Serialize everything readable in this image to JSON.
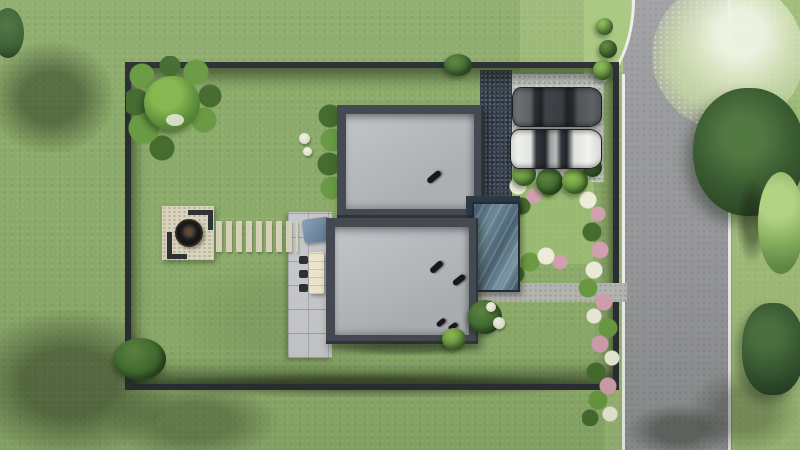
{
  "scene": {
    "title": "Aerial 3D render of a residential plot",
    "description": "Top-down architectural visualization: fenced lawn plot containing two flat-roofed house volumes joined by a glass canopy, a concrete driveway with a dark car and a white car, a stone fire-pit patio with corner benches, a stepping-stone path, a paved terrace with outdoor dining furniture, flower beds along the right fence, and a vertical asphalt road with white edge lines and trees on the right side.",
    "visible_text": "none"
  },
  "colors": {
    "grass": "#8cab6a",
    "grass-bright": "#a8c77f",
    "road": "#9b9c9f",
    "road-line": "#eceeea",
    "fence": "#2a2d32",
    "parapet": "#454a52",
    "roof-hi": "#c2c5c8",
    "roof-lo": "#abafb2",
    "concrete": "#c8cac7",
    "gravel": "#38414d",
    "glass-1": "#6c8798",
    "glass-2": "#3e5565",
    "terrace": "#c6c7c9",
    "path": "#b5b6b2",
    "stone": "#d4cfb6",
    "patio": "#d9d3be",
    "bench": "#2f3235",
    "fire": "#141516",
    "table": "#ece4c9",
    "chair": "#2e3134",
    "lounge-1": "#8aa0b4",
    "lounge-2": "#5a7590",
    "bush-hi": "#8fba55",
    "bush-mid": "#6a9a43",
    "bush-dk": "#466c30",
    "tree-hi": "#86b750",
    "foliage-dk": "#3a5c31",
    "blossom": "#e7eeda",
    "flower-pink": "#d29fae",
    "flower-white": "#eaebd9",
    "car-dark": "#54585c",
    "car-white": "#e8e9e6",
    "shadow": "rgba(25,34,18,0.45)"
  },
  "legend": [
    {
      "name": "plot-fence",
      "label": "Dark perimeter fence"
    },
    {
      "name": "building-upper",
      "label": "North flat-roof house volume"
    },
    {
      "name": "building-lower",
      "label": "South flat-roof house volume"
    },
    {
      "name": "glass-canopy",
      "label": "Glass link canopy"
    },
    {
      "name": "driveway-pad",
      "label": "Concrete parking pad"
    },
    {
      "name": "car-dark",
      "label": "Dark gray car"
    },
    {
      "name": "car-white",
      "label": "White car"
    },
    {
      "name": "firepit-patio",
      "label": "Stone patio with fire bowl and corner benches"
    },
    {
      "name": "stepping-path",
      "label": "Stepping stone path"
    },
    {
      "name": "terrace",
      "label": "Paved terrace with dining table, chairs and lounge"
    },
    {
      "name": "road",
      "label": "Asphalt road with white edge lines"
    },
    {
      "name": "flower-beds",
      "label": "Flowering shrub borders"
    },
    {
      "name": "trees",
      "label": "Trees, bushes and cast shadows"
    }
  ]
}
